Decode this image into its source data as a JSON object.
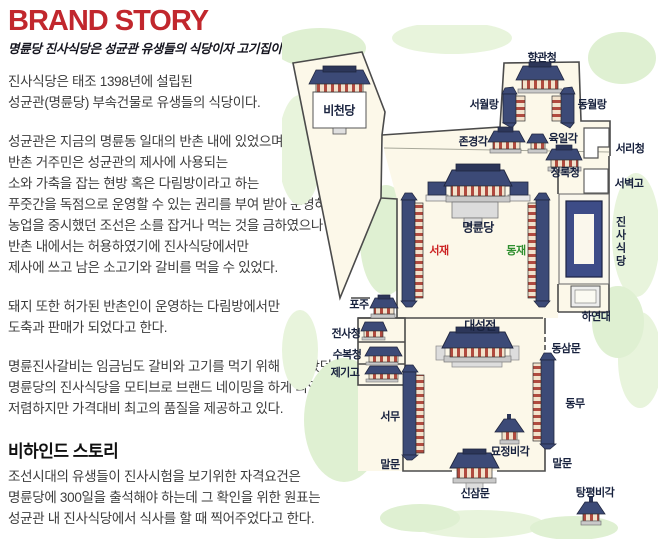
{
  "header": {
    "title": "BRAND STORY",
    "subtitle": "명륜당 진사식당은 성균관 유생들의 식당이자 고기집이다."
  },
  "story": {
    "p1": "진사식당은 태조 1398년에 설립된\n성균관(명륜당) 부속건물로 유생들의 식당이다.",
    "p2": "성균관은 지금의 명륜동 일대의 반촌 내에 있었으며\n반촌 거주민은 성균관의 제사에 사용되는\n소와 가축을 잡는 현방 혹은 다림방이라고 하는\n푸줏간을 독점으로 운영할 수 있는 권리를 부여 받아 운영하였다.\n농업을 중시했던 조선은 소를 잡거나 먹는 것을 금하였으나\n반촌 내에서는 허용하였기에 진사식당에서만\n제사에 쓰고 남은 소고기와 갈비를 먹을 수 있었다.",
    "p3": "돼지 또한 허가된 반촌인이 운영하는 다림방에서만\n도축과 판매가 되었다고 한다.",
    "p4": "명륜진사갈비는 임금님도 갈비와 고기를 먹기 위해 찾아왔던\n명륜당의 진사식당을 모티브로 브랜드 네이밍을 하게 되었고\n저렴하지만 가격대비 최고의 품질을 제공하고 있다.",
    "behind_title": "비하인드 스토리",
    "p5": "조선시대의 유생들이 진사시험을 보기위한 자격요건은\n명륜당에 300일을 출석해야 하는데 그 확인을 위한 원표는\n성균관 내 진사식당에서 식사를 할 때 찍어주었다고 한다."
  },
  "map": {
    "labels": {
      "bicheondang": "비천당",
      "hyanggwancheong": "향관청",
      "seowollang": "서월랑",
      "dongwollang": "동월랑",
      "jongyeonggak": "존경각",
      "yukilgak": "육일각",
      "seoricheong": "서리청",
      "jeongnokcheong": "정록청",
      "seobyeokgo": "서벽고",
      "myeongnyundang": "명륜당",
      "seojae": "서재",
      "dongjae": "동재",
      "jinsasikdang": "진사식당",
      "hayeondae": "하연대",
      "poju": "포주",
      "jeonsacheong": "전사청",
      "subokcheong": "수복청",
      "jegigo": "제기고",
      "seomu": "서무",
      "daeseongjeon": "대성전",
      "dongsammun": "동삼문",
      "dongmu": "동무",
      "myojeongbigak": "묘정비각",
      "malmun_left": "말문",
      "malmun_right": "말문",
      "sinsammun": "신삼문",
      "tangpyeongbigak": "탕평비각"
    },
    "colors": {
      "title_red": "#c1272d",
      "body_text": "#3c3c3c",
      "label_text": "#18223e",
      "seojae_label": "#cc2222",
      "dongjae_label": "#2f8f2f",
      "roof_navy": "#3c4a77",
      "column_red": "#b04a3f",
      "courtyard_cream": "#fcf8e9",
      "greenery": "#dff0d2",
      "highlight_building": "#3d4c87",
      "wall_line": "#4b4b4b"
    }
  }
}
